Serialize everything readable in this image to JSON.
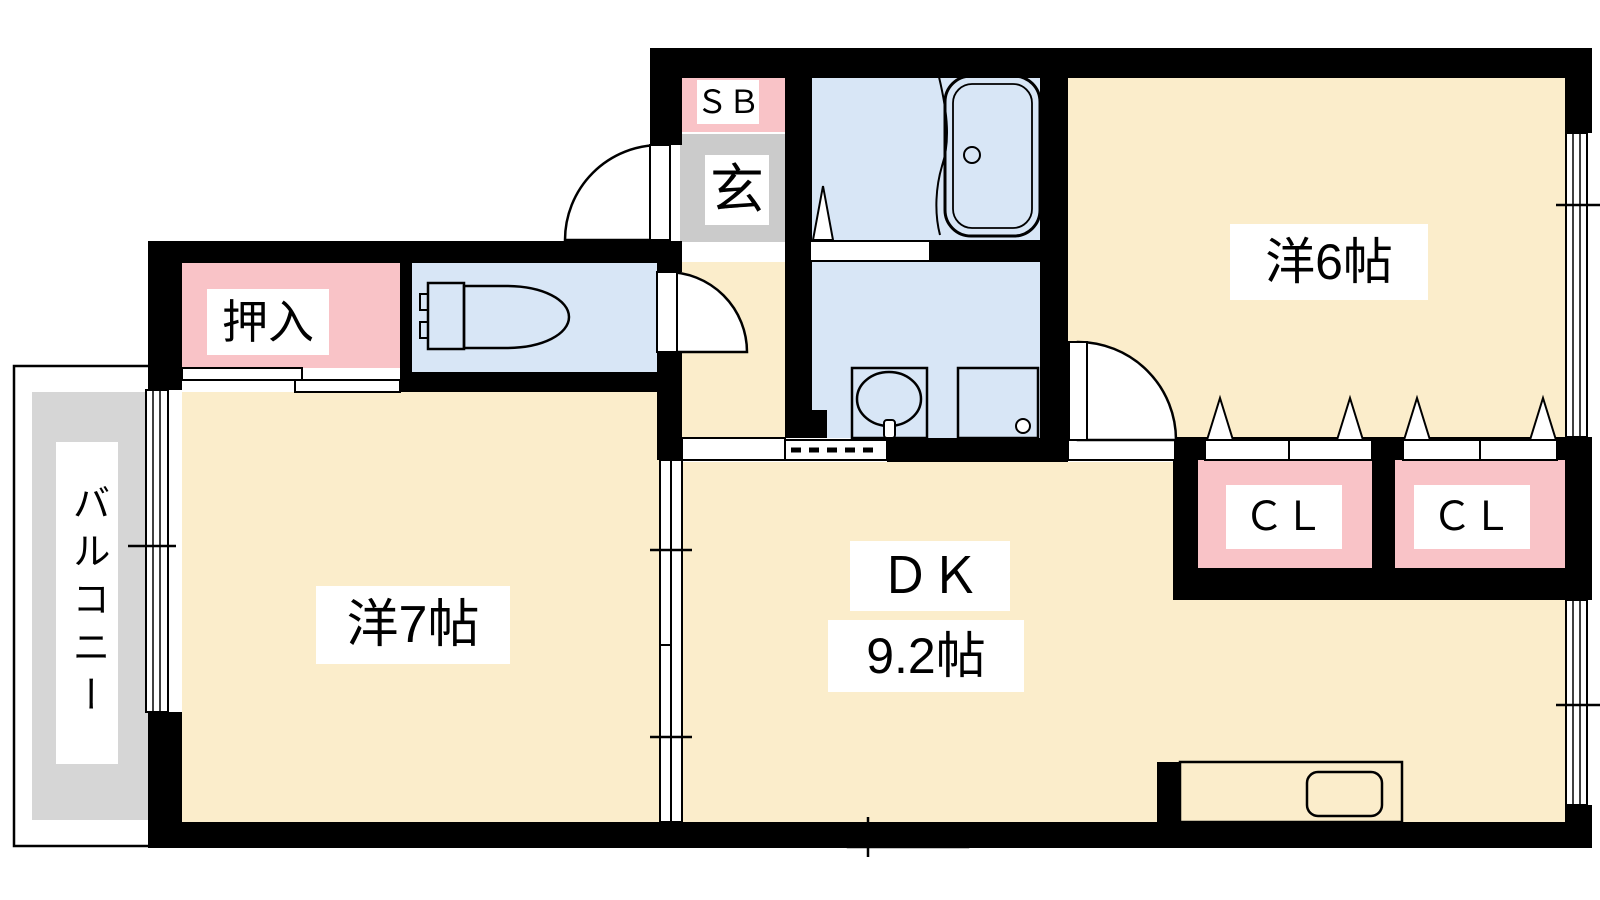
{
  "title": "apartment-floor-plan",
  "colors": {
    "wall": "#000000",
    "bg": "#FFFFFF",
    "room_cream": "#FBEDCB",
    "water_blue": "#D8E6F6",
    "closet_pink": "#F9C3C7",
    "genkan_gray": "#CBCBCB",
    "balcony_gray": "#D6D6D6",
    "counter_purple": "#E8DFF4",
    "label_bg": "#FFFFFF",
    "text": "#000000"
  },
  "labels": {
    "balcony": "バルコニー",
    "oshiire": "押入",
    "sb": "ＳＢ",
    "genkan": "玄",
    "room6": "洋6帖",
    "room7": "洋7帖",
    "dk": "ＤＫ",
    "dk_size": "9.2帖",
    "cl1": "ＣＬ",
    "cl2": "ＣＬ"
  },
  "rooms": [
    {
      "name": "western-room-6",
      "label": "洋6帖"
    },
    {
      "name": "western-room-7",
      "label": "洋7帖"
    },
    {
      "name": "dining-kitchen",
      "label": "ＤＫ 9.2帖"
    },
    {
      "name": "entrance",
      "label": "玄"
    },
    {
      "name": "shoe-box",
      "label": "ＳＢ"
    },
    {
      "name": "closet-oshiire",
      "label": "押入"
    },
    {
      "name": "closet-1",
      "label": "ＣＬ"
    },
    {
      "name": "closet-2",
      "label": "ＣＬ"
    },
    {
      "name": "balcony",
      "label": "バルコニー"
    }
  ]
}
